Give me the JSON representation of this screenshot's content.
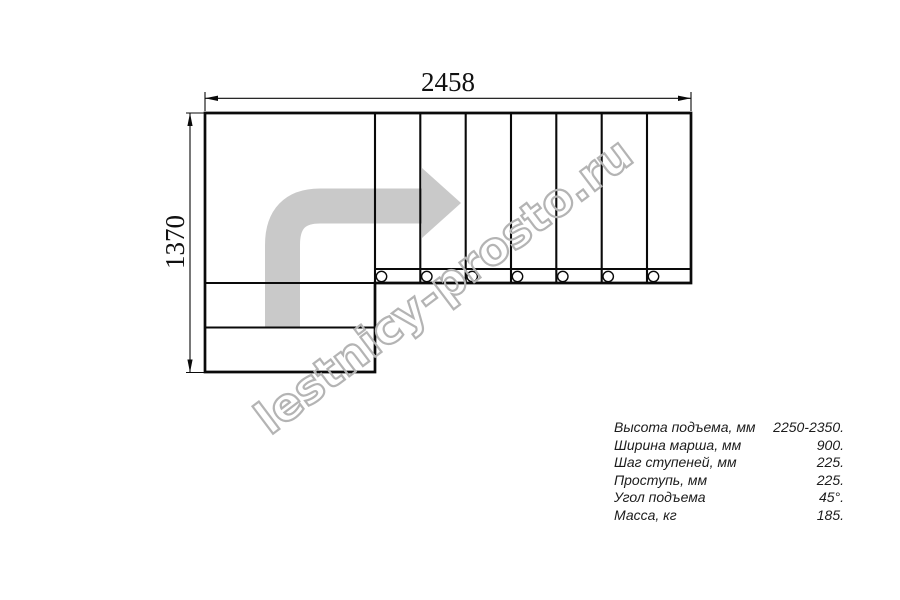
{
  "dimensions": {
    "width_label": "2458",
    "height_label": "1370"
  },
  "watermark": {
    "text": "lestnicy-prosto.ru"
  },
  "specs": {
    "rows": [
      {
        "label": "Высота подъема, мм",
        "value": "2250-2350."
      },
      {
        "label": "Ширина марша, мм",
        "value": "900."
      },
      {
        "label": "Шаг ступеней, мм",
        "value": "225."
      },
      {
        "label": "Проступь, мм",
        "value": "225."
      },
      {
        "label": "Угол подъема",
        "value": "45°."
      },
      {
        "label": "Масса, кг",
        "value": "185."
      }
    ]
  },
  "plan": {
    "tread_count": 7,
    "fastener_circle_count": 7
  },
  "colors": {
    "line": "#0a0a0a",
    "arrow_fill": "#c9c9c9",
    "watermark_outline": "#b4b4b4",
    "background": "#ffffff"
  }
}
